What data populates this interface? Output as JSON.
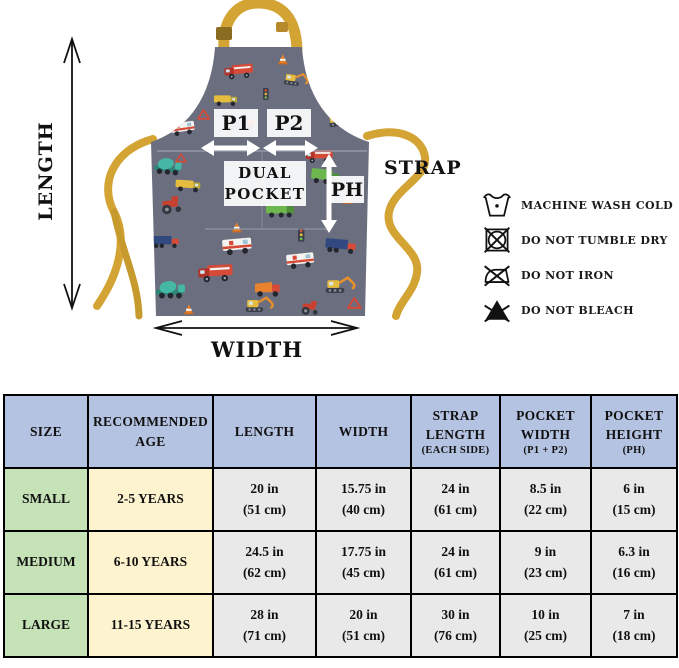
{
  "diagram": {
    "length_label": "LENGTH",
    "width_label": "WIDTH",
    "strap_label": "STRAP",
    "p1_label": "P1",
    "p2_label": "P2",
    "dual_pocket_line1": "DUAL",
    "dual_pocket_line2": "POCKET",
    "ph_label": "PH",
    "colors": {
      "apron_fabric": "#6b6e7e",
      "strap_yellow": "#d3a433",
      "arrow_black": "#111111",
      "arrow_white": "#ffffff"
    }
  },
  "care_instructions": {
    "items": [
      {
        "icon": "machine-wash-cold-icon",
        "label": "MACHINE WASH COLD"
      },
      {
        "icon": "do-not-tumble-dry-icon",
        "label": "DO NOT TUMBLE DRY"
      },
      {
        "icon": "do-not-iron-icon",
        "label": "DO NOT IRON"
      },
      {
        "icon": "do-not-bleach-icon",
        "label": "DO NOT BLEACH"
      }
    ]
  },
  "size_chart": {
    "headers": [
      {
        "label": "SIZE",
        "sub": ""
      },
      {
        "label": "RECOMMENDED AGE",
        "sub": ""
      },
      {
        "label": "LENGTH",
        "sub": ""
      },
      {
        "label": "WIDTH",
        "sub": ""
      },
      {
        "label": "STRAP LENGTH",
        "sub": "(EACH SIDE)"
      },
      {
        "label": "POCKET WIDTH",
        "sub": "(P1 + P2)"
      },
      {
        "label": "POCKET HEIGHT",
        "sub": "(PH)"
      }
    ],
    "rows": [
      {
        "size": "SMALL",
        "age": "2-5 YEARS",
        "length_in": "20 in",
        "length_cm": "(51 cm)",
        "width_in": "15.75 in",
        "width_cm": "(40 cm)",
        "strap_in": "24 in",
        "strap_cm": "(61 cm)",
        "pocket_width_in": "8.5 in",
        "pocket_width_cm": "(22 cm)",
        "pocket_height_in": "6 in",
        "pocket_height_cm": "(15 cm)"
      },
      {
        "size": "MEDIUM",
        "age": "6-10 YEARS",
        "length_in": "24.5 in",
        "length_cm": "(62 cm)",
        "width_in": "17.75 in",
        "width_cm": "(45 cm)",
        "strap_in": "24 in",
        "strap_cm": "(61 cm)",
        "pocket_width_in": "9 in",
        "pocket_width_cm": "(23 cm)",
        "pocket_height_in": "6.3 in",
        "pocket_height_cm": "(16 cm)"
      },
      {
        "size": "LARGE",
        "age": "11-15 YEARS",
        "length_in": "28 in",
        "length_cm": "(71 cm)",
        "width_in": "20 in",
        "width_cm": "(51 cm)",
        "strap_in": "30 in",
        "strap_cm": "(76 cm)",
        "pocket_width_in": "10 in",
        "pocket_width_cm": "(25 cm)",
        "pocket_height_in": "7 in",
        "pocket_height_cm": "(18 cm)"
      }
    ]
  }
}
